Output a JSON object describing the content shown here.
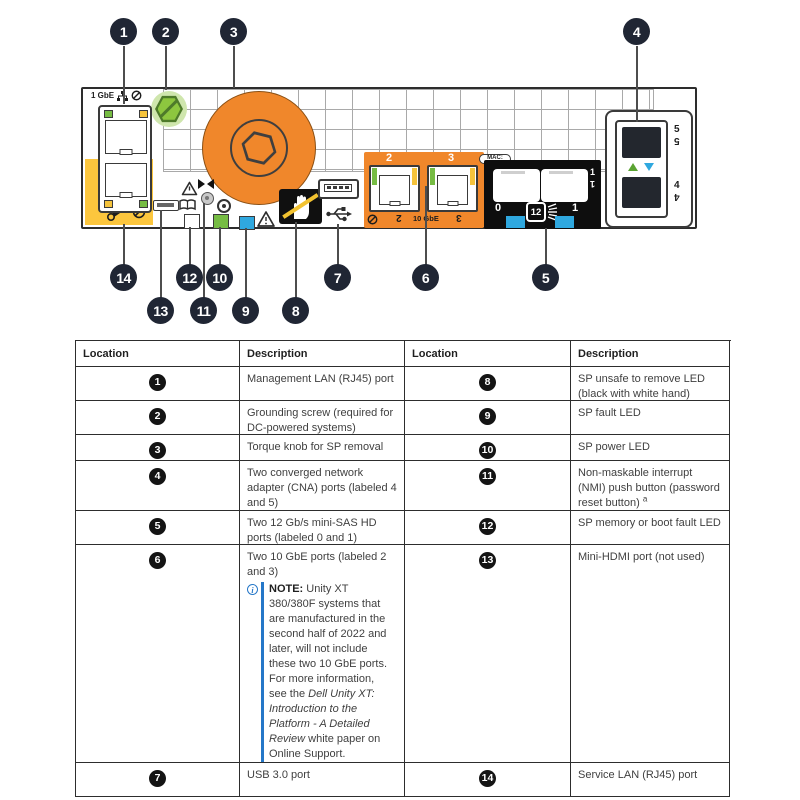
{
  "colors": {
    "orange": "#F0872B",
    "service_yellow": "#FCC63D",
    "led_green": "#76BC43",
    "led_blue": "#2FA8DF",
    "screw_green": "#8DC63F",
    "callout_bg": "#202634",
    "note_blue": "#2577C8",
    "sas_block_black": "#0E0E0E"
  },
  "diagram": {
    "gbe_label": "1 GbE",
    "mac_label": "MAC:",
    "ten_gbe_label": "10 GbE",
    "port2_label": "2",
    "port3_label": "3",
    "sas_port0_label": "0",
    "sas_port1_label": "1",
    "sas_speed_label": "12",
    "cna_port5_label": "5",
    "cna_port4_label": "4",
    "callouts": {
      "n1": "1",
      "n2": "2",
      "n3": "3",
      "n4": "4",
      "n5": "5",
      "n6": "6",
      "n7": "7",
      "n8": "8",
      "n9": "9",
      "n10": "10",
      "n11": "11",
      "n12": "12",
      "n13": "13",
      "n14": "14"
    }
  },
  "table": {
    "headers": [
      "Location",
      "Description",
      "Location",
      "Description"
    ],
    "rows": [
      {
        "l_num": "1",
        "l_desc": "Management LAN (RJ45) port",
        "r_num": "8",
        "r_desc": "SP unsafe to remove LED (black with white hand)"
      },
      {
        "l_num": "2",
        "l_desc": "Grounding screw (required for DC-powered systems)",
        "r_num": "9",
        "r_desc": "SP fault LED"
      },
      {
        "l_num": "3",
        "l_desc": "Torque knob for SP removal",
        "r_num": "10",
        "r_desc": "SP power LED"
      },
      {
        "l_num": "4",
        "l_desc": "Two converged network adapter (CNA) ports (labeled 4 and 5)",
        "r_num": "11",
        "r_desc": "Non-maskable interrupt (NMI) push button (password reset button)",
        "r_footnote": "a"
      },
      {
        "l_num": "5",
        "l_desc": "Two 12 Gb/s mini-SAS HD ports (labeled 0 and 1)",
        "r_num": "12",
        "r_desc": "SP memory or boot fault LED"
      },
      {
        "l_num": "6",
        "l_desc": "Two 10 GbE ports (labeled 2 and 3)",
        "r_num": "13",
        "r_desc": "Mini-HDMI port (not used)"
      },
      {
        "l_num": "7",
        "l_desc": "USB 3.0 port",
        "r_num": "14",
        "r_desc": "Service LAN (RJ45) port"
      }
    ],
    "note": {
      "label": "NOTE:",
      "before": " Unity XT 380/380F systems that are manufactured in the second half of 2022 and later, will not include these two 10 GbE ports. For more information, see the ",
      "title": "Dell Unity XT: Introduction to the Platform - A Detailed Review",
      "after": " white paper on Online Support."
    }
  }
}
